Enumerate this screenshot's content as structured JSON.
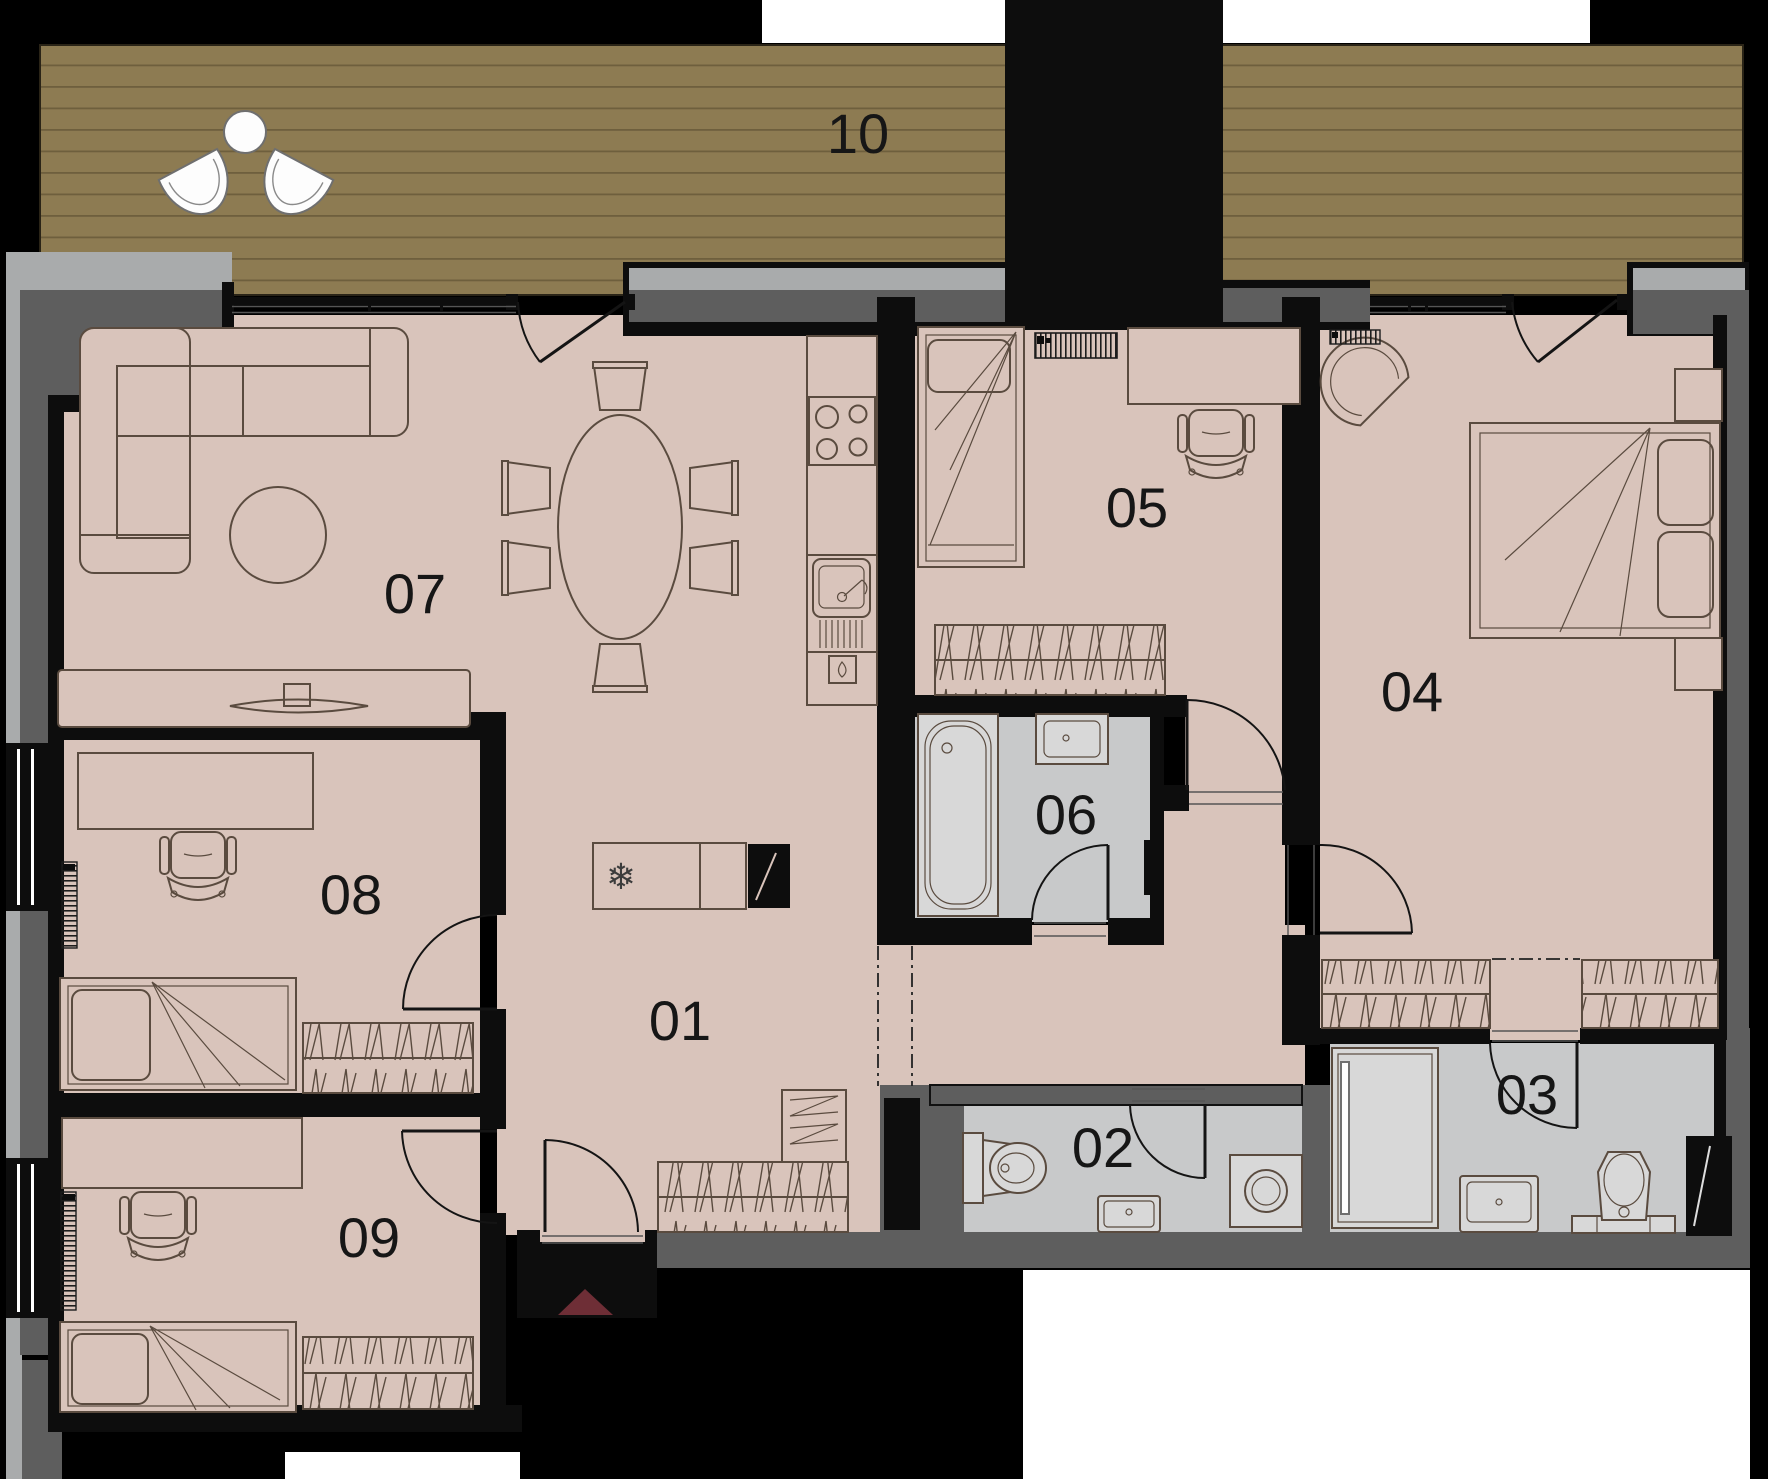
{
  "rooms": [
    {
      "id": "01",
      "label": "01"
    },
    {
      "id": "02",
      "label": "02"
    },
    {
      "id": "03",
      "label": "03"
    },
    {
      "id": "04",
      "label": "04"
    },
    {
      "id": "05",
      "label": "05"
    },
    {
      "id": "06",
      "label": "06"
    },
    {
      "id": "07",
      "label": "07"
    },
    {
      "id": "08",
      "label": "08"
    },
    {
      "id": "09",
      "label": "09"
    },
    {
      "id": "10",
      "label": "10"
    }
  ],
  "icons": {
    "snowflake": "❄"
  },
  "colors": {
    "floor": "#d9c4bb",
    "wet_floor": "#c8c9ca",
    "fixture": "#d8d8d8",
    "deck": "#8d7b52",
    "deck_line": "#6e5f3d",
    "wall_black": "#0d0d0d",
    "wall_dark": "#5e5e5e",
    "wall_light": "#a9abac",
    "line": "#5a4b3f",
    "entry_marker": "#6e2e36",
    "door_line": "#141414",
    "label": "#161616",
    "white": "#ffffff"
  }
}
